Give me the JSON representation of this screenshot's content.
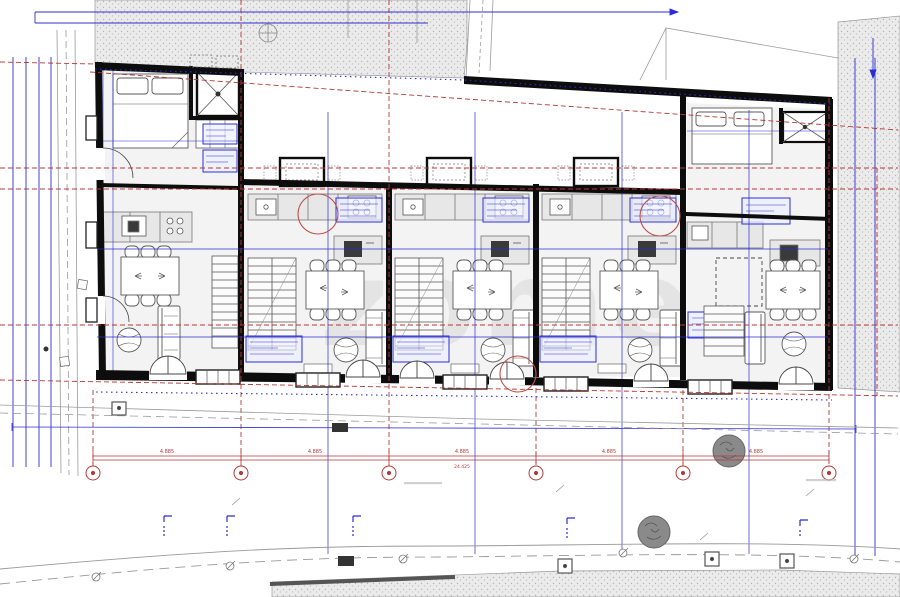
{
  "drawing": {
    "kind": "architectural site / floor plan, 5 terraced housing units",
    "watermark": "zome",
    "colors": {
      "wall": "#0d0d0d",
      "red_annotation": "#b03a36",
      "blue_annotation": "#2c2cd6",
      "stipple_bg": "#ebebeb",
      "stipple_dot": "#b5b5b5",
      "furniture_stroke": "#5a5a5a",
      "road_gray": "#999999",
      "watermark_gray": "#ececec"
    }
  },
  "dimensions": {
    "bays": [
      "4.885",
      "4.885",
      "4.885",
      "4.885",
      "4.885"
    ],
    "total": "24.425"
  },
  "grid": {
    "marker_xs": [
      93,
      241,
      389,
      536,
      683,
      829
    ],
    "marker_y": 473
  },
  "units": {
    "count": 5,
    "entrance_doors_x": [
      150,
      346,
      400,
      490,
      634,
      779
    ]
  }
}
